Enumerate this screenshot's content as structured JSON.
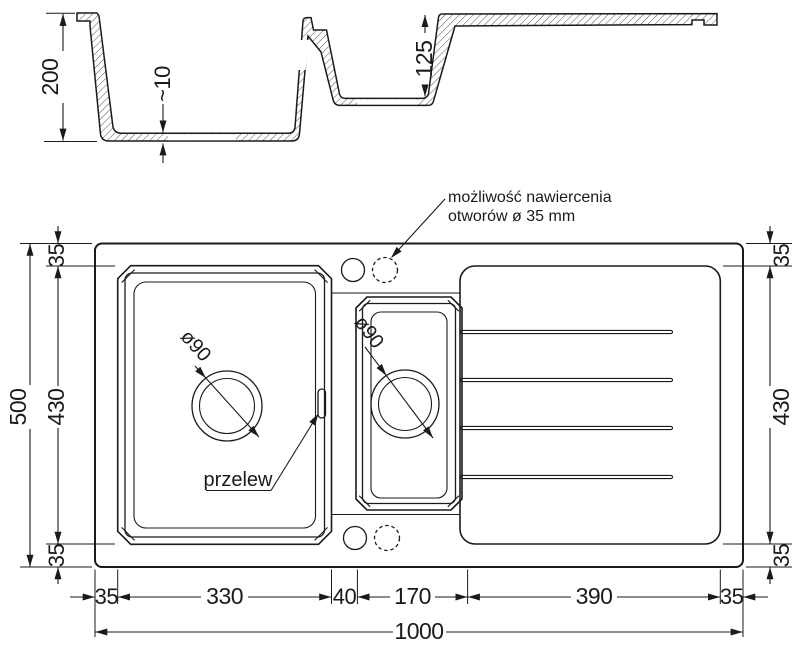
{
  "drawing": {
    "section": {
      "dim_total_depth": "200",
      "dim_bottom_thickness": "~10",
      "dim_small_bowl_depth": "125"
    },
    "plan": {
      "note_line1": "możliwość nawiercenia",
      "note_line2": "otworów ø 35 mm",
      "overflow_label": "przelew",
      "main_drain_label": "ø90",
      "small_drain_label": "ø90",
      "dim_left_total": "500",
      "dim_left_top": "35",
      "dim_left_middle": "430",
      "dim_left_bottom": "35",
      "dim_right_top": "35",
      "dim_right_middle": "430",
      "dim_right_bottom": "35",
      "dim_bottom_segments": [
        "35",
        "330",
        "40",
        "170",
        "390",
        "35"
      ],
      "dim_bottom_total": "1000"
    },
    "colors": {
      "line": "#1a1a1a",
      "hatch": "#555555",
      "background": "#ffffff"
    }
  }
}
